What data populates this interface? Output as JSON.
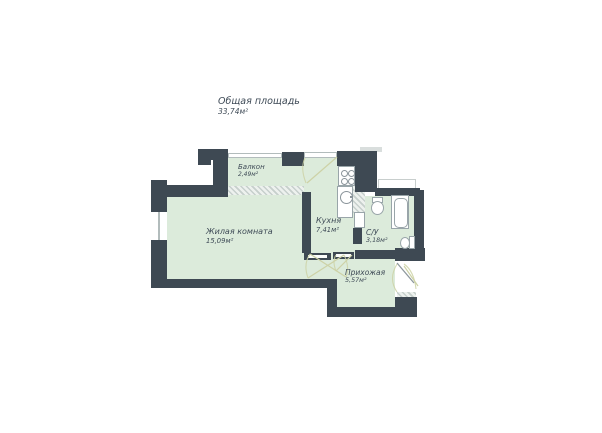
{
  "title": {
    "label": "Общая площадь",
    "value": "33,74м²"
  },
  "rooms": {
    "balcony": {
      "name": "Балкон",
      "area": "2,49м²"
    },
    "living": {
      "name": "Жилая комната",
      "area": "15,09м²"
    },
    "kitchen": {
      "name": "Кухня",
      "area": "7,41м²"
    },
    "bathroom": {
      "name": "С/У",
      "area": "3,18м²"
    },
    "hallway": {
      "name": "Прихожая",
      "area": "5,57м²"
    }
  },
  "watermark": "ТМ",
  "colors": {
    "wall": "#3e4953",
    "fill": "#dcebdb",
    "label": "#3f4b57",
    "arc": "#cdd2a6"
  }
}
